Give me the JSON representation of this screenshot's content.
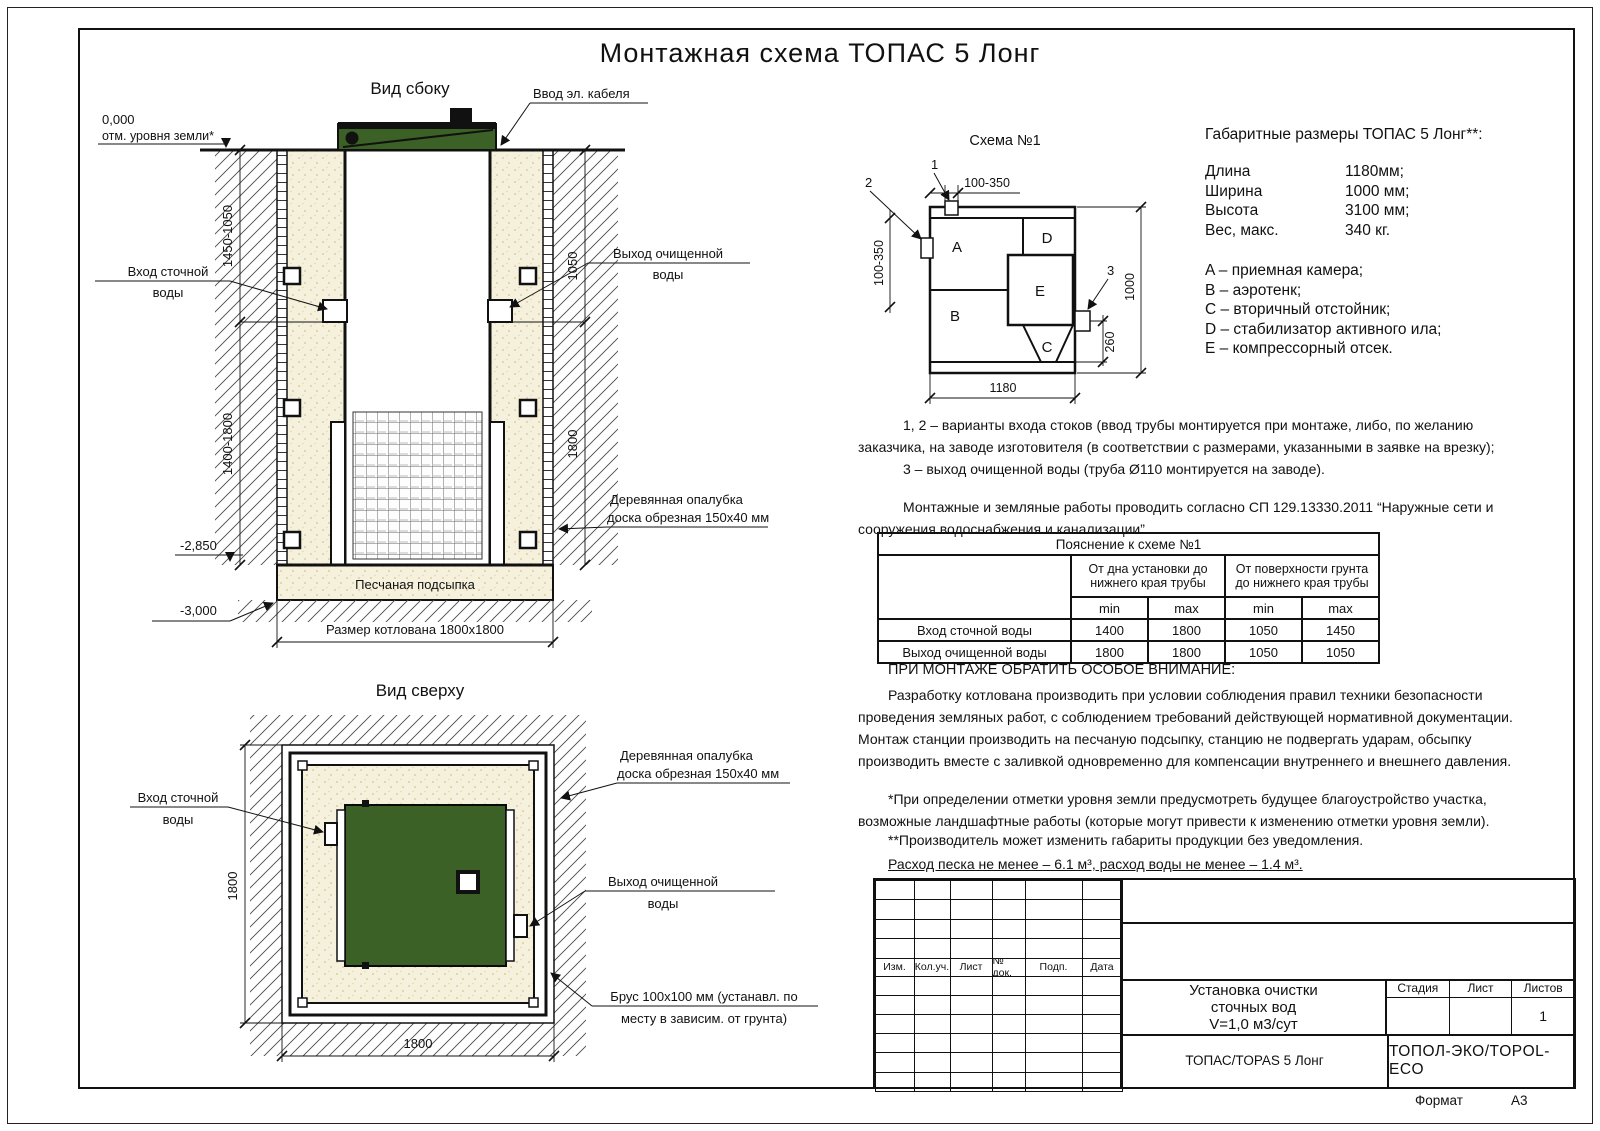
{
  "title": "Монтажная схема ТОПАС 5 Лонг",
  "side_view": {
    "label": "Вид сбоку",
    "cable_label": "Ввод эл. кабеля",
    "level_zero": "0,000",
    "level_zero_caption": "отм. уровня земли*",
    "inlet_line1": "Вход сточной",
    "inlet_line2": "воды",
    "outlet_line1": "Выход очищенной",
    "outlet_line2": "воды",
    "dims": {
      "left_upper": "1450-1050",
      "left_lower": "1400-1800",
      "right_upper": "1050",
      "right_lower": "1800"
    },
    "level_floor": "-2,850",
    "level_bottom": "-3,000",
    "sand_label": "Песчаная подсыпка",
    "pit_label": "Размер котлована 1800x1800",
    "formwork_line1": "Деревянная опалубка",
    "formwork_line2": "доска обрезная 150x40 мм"
  },
  "top_view": {
    "label": "Вид сверху",
    "inlet_line1": "Вход сточной",
    "inlet_line2": "воды",
    "outlet_line1": "Выход очищенной",
    "outlet_line2": "воды",
    "formwork_line1": "Деревянная опалубка",
    "formwork_line2": "доска обрезная 150x40 мм",
    "beam_line1": "Брус 100x100 мм (устанавл. по",
    "beam_line2": "месту в зависим. от грунта)",
    "dims": {
      "left": "1800",
      "bottom": "1800"
    }
  },
  "scheme": {
    "title": "Схема №1",
    "compartments": {
      "a": "A",
      "b": "B",
      "c": "C",
      "d": "D",
      "e": "E"
    },
    "markers": {
      "m1": "1",
      "m2": "2",
      "m3": "3"
    },
    "dims": {
      "top": "100-350",
      "left": "100-350",
      "right": "1000",
      "outlet": "260",
      "bottom": "1180"
    }
  },
  "specs": {
    "heading": "Габаритные размеры ТОПАС 5 Лонг**:",
    "rows": [
      {
        "label": "Длина",
        "value": "1180мм;"
      },
      {
        "label": "Ширина",
        "value": "1000 мм;"
      },
      {
        "label": "Высота",
        "value": "3100 мм;"
      },
      {
        "label": "Вес, макс.",
        "value": "340 кг."
      }
    ],
    "legend": [
      "A – приемная камера;",
      "B – аэротенк;",
      "C – вторичный отстойник;",
      "D – стабилизатор активного ила;",
      "E – компрессорный отсек."
    ]
  },
  "notes": {
    "p1": "1, 2 – варианты входа  стоков (ввод трубы монтируется при монтаже, либо, по желанию заказчика, на заводе изготовителя (в соответствии с размерами, указанными в заявке на врезку);",
    "p2": "3 – выход очищенной воды (труба Ø110 монтируется на заводе).",
    "p3": "Монтажные и земляные работы проводить согласно СП 129.13330.2011 “Наружные сети и сооружения водоснабжения и канализации”."
  },
  "table": {
    "title": "Пояснение к схеме №1",
    "group1": "От дна установки до нижнего края трубы",
    "group2": "От поверхности грунта до нижнего края трубы",
    "min": "min",
    "max": "max",
    "rows": [
      {
        "label": "Вход сточной воды",
        "v": [
          "1400",
          "1800",
          "1050",
          "1450"
        ]
      },
      {
        "label": "Выход очищенной воды",
        "v": [
          "1800",
          "1800",
          "1050",
          "1050"
        ]
      }
    ]
  },
  "warnings": {
    "heading": "ПРИ МОНТАЖЕ ОБРАТИТЬ ОСОБОЕ ВНИМАНИЕ:",
    "body": "Разработку котлована производить при условии соблюдения правил техники безопасности проведения земляных работ, с соблюдением требований действующей нормативной документации. Монтаж станции производить на песчаную подсыпку, станцию не подвергать ударам, обсыпку производить вместе с заливкой одновременно для компенсации внутреннего и внешнего давления.",
    "footnote1": "*При определении отметки уровня земли предусмотреть будущее благоустройство участка, возможные ландшафтные работы (которые могут привести к изменению отметки уровня земли).",
    "footnote2": "**Производитель может изменить габариты продукции без уведомления.",
    "consumption": "Расход песка не менее – 6.1 м³, расход воды не менее – 1.4 м³."
  },
  "stamp": {
    "rev_headers": [
      "Изм.",
      "Кол.уч.",
      "Лист",
      "№ док.",
      "Подп.",
      "Дата"
    ],
    "doc_title_line1": "Установка очистки",
    "doc_title_line2": "сточных вод",
    "doc_title_line3": "V=1,0 м3/сут",
    "stage": "Стадия",
    "sheet": "Лист",
    "sheets": "Листов",
    "sheets_value": "1",
    "product": "ТОПАС/TOPAS 5 Лонг",
    "company": "ТОПОЛ-ЭКО/TOPOL-ECO",
    "format_label": "Формат",
    "format_value": "А3"
  },
  "colors": {
    "green": "#3c6126",
    "sand": "#f6f1dd",
    "line": "#111111"
  }
}
